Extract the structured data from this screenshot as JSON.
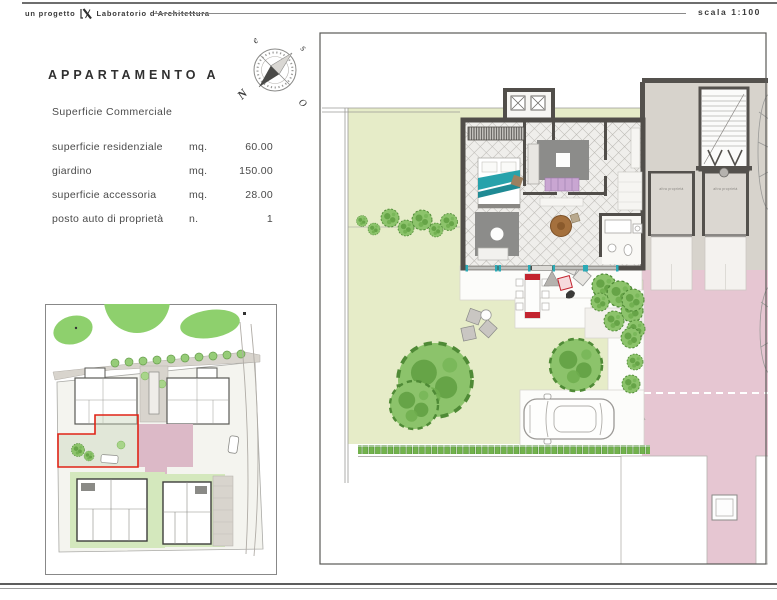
{
  "header": {
    "prefix": "un progetto",
    "studio": "Laboratorio d'Architettura",
    "scale": "scala 1:100"
  },
  "apartment": {
    "title": "APPARTAMENTO A",
    "subtitle": "Superficie Commerciale",
    "rows": [
      {
        "label": "superficie residenziale",
        "unit": "mq.",
        "value": "60.00"
      },
      {
        "label": "giardino",
        "unit": "mq.",
        "value": "150.00"
      },
      {
        "label": "superficie accessoria",
        "unit": "mq.",
        "value": "28.00"
      },
      {
        "label": "posto auto di proprietà",
        "unit": "n.",
        "value": "1"
      }
    ]
  },
  "compass": {
    "north": "N",
    "south": "s",
    "east": "e",
    "west": "O"
  },
  "floor_plan": {
    "other_property_left": "altra proprietà",
    "other_property_right": "altra proprietà"
  },
  "colors": {
    "garden_green": "#e6ecc8",
    "tree_green": "#8cc36b",
    "hedge_green": "#72b24c",
    "road_pink": "#e6c6d2",
    "wall_dark": "#514e4a",
    "rug_gray": "#8c8c8a",
    "teal_accent": "#2aaab6",
    "red_accent": "#c3242f",
    "site_highlight_red": "#e02417"
  }
}
